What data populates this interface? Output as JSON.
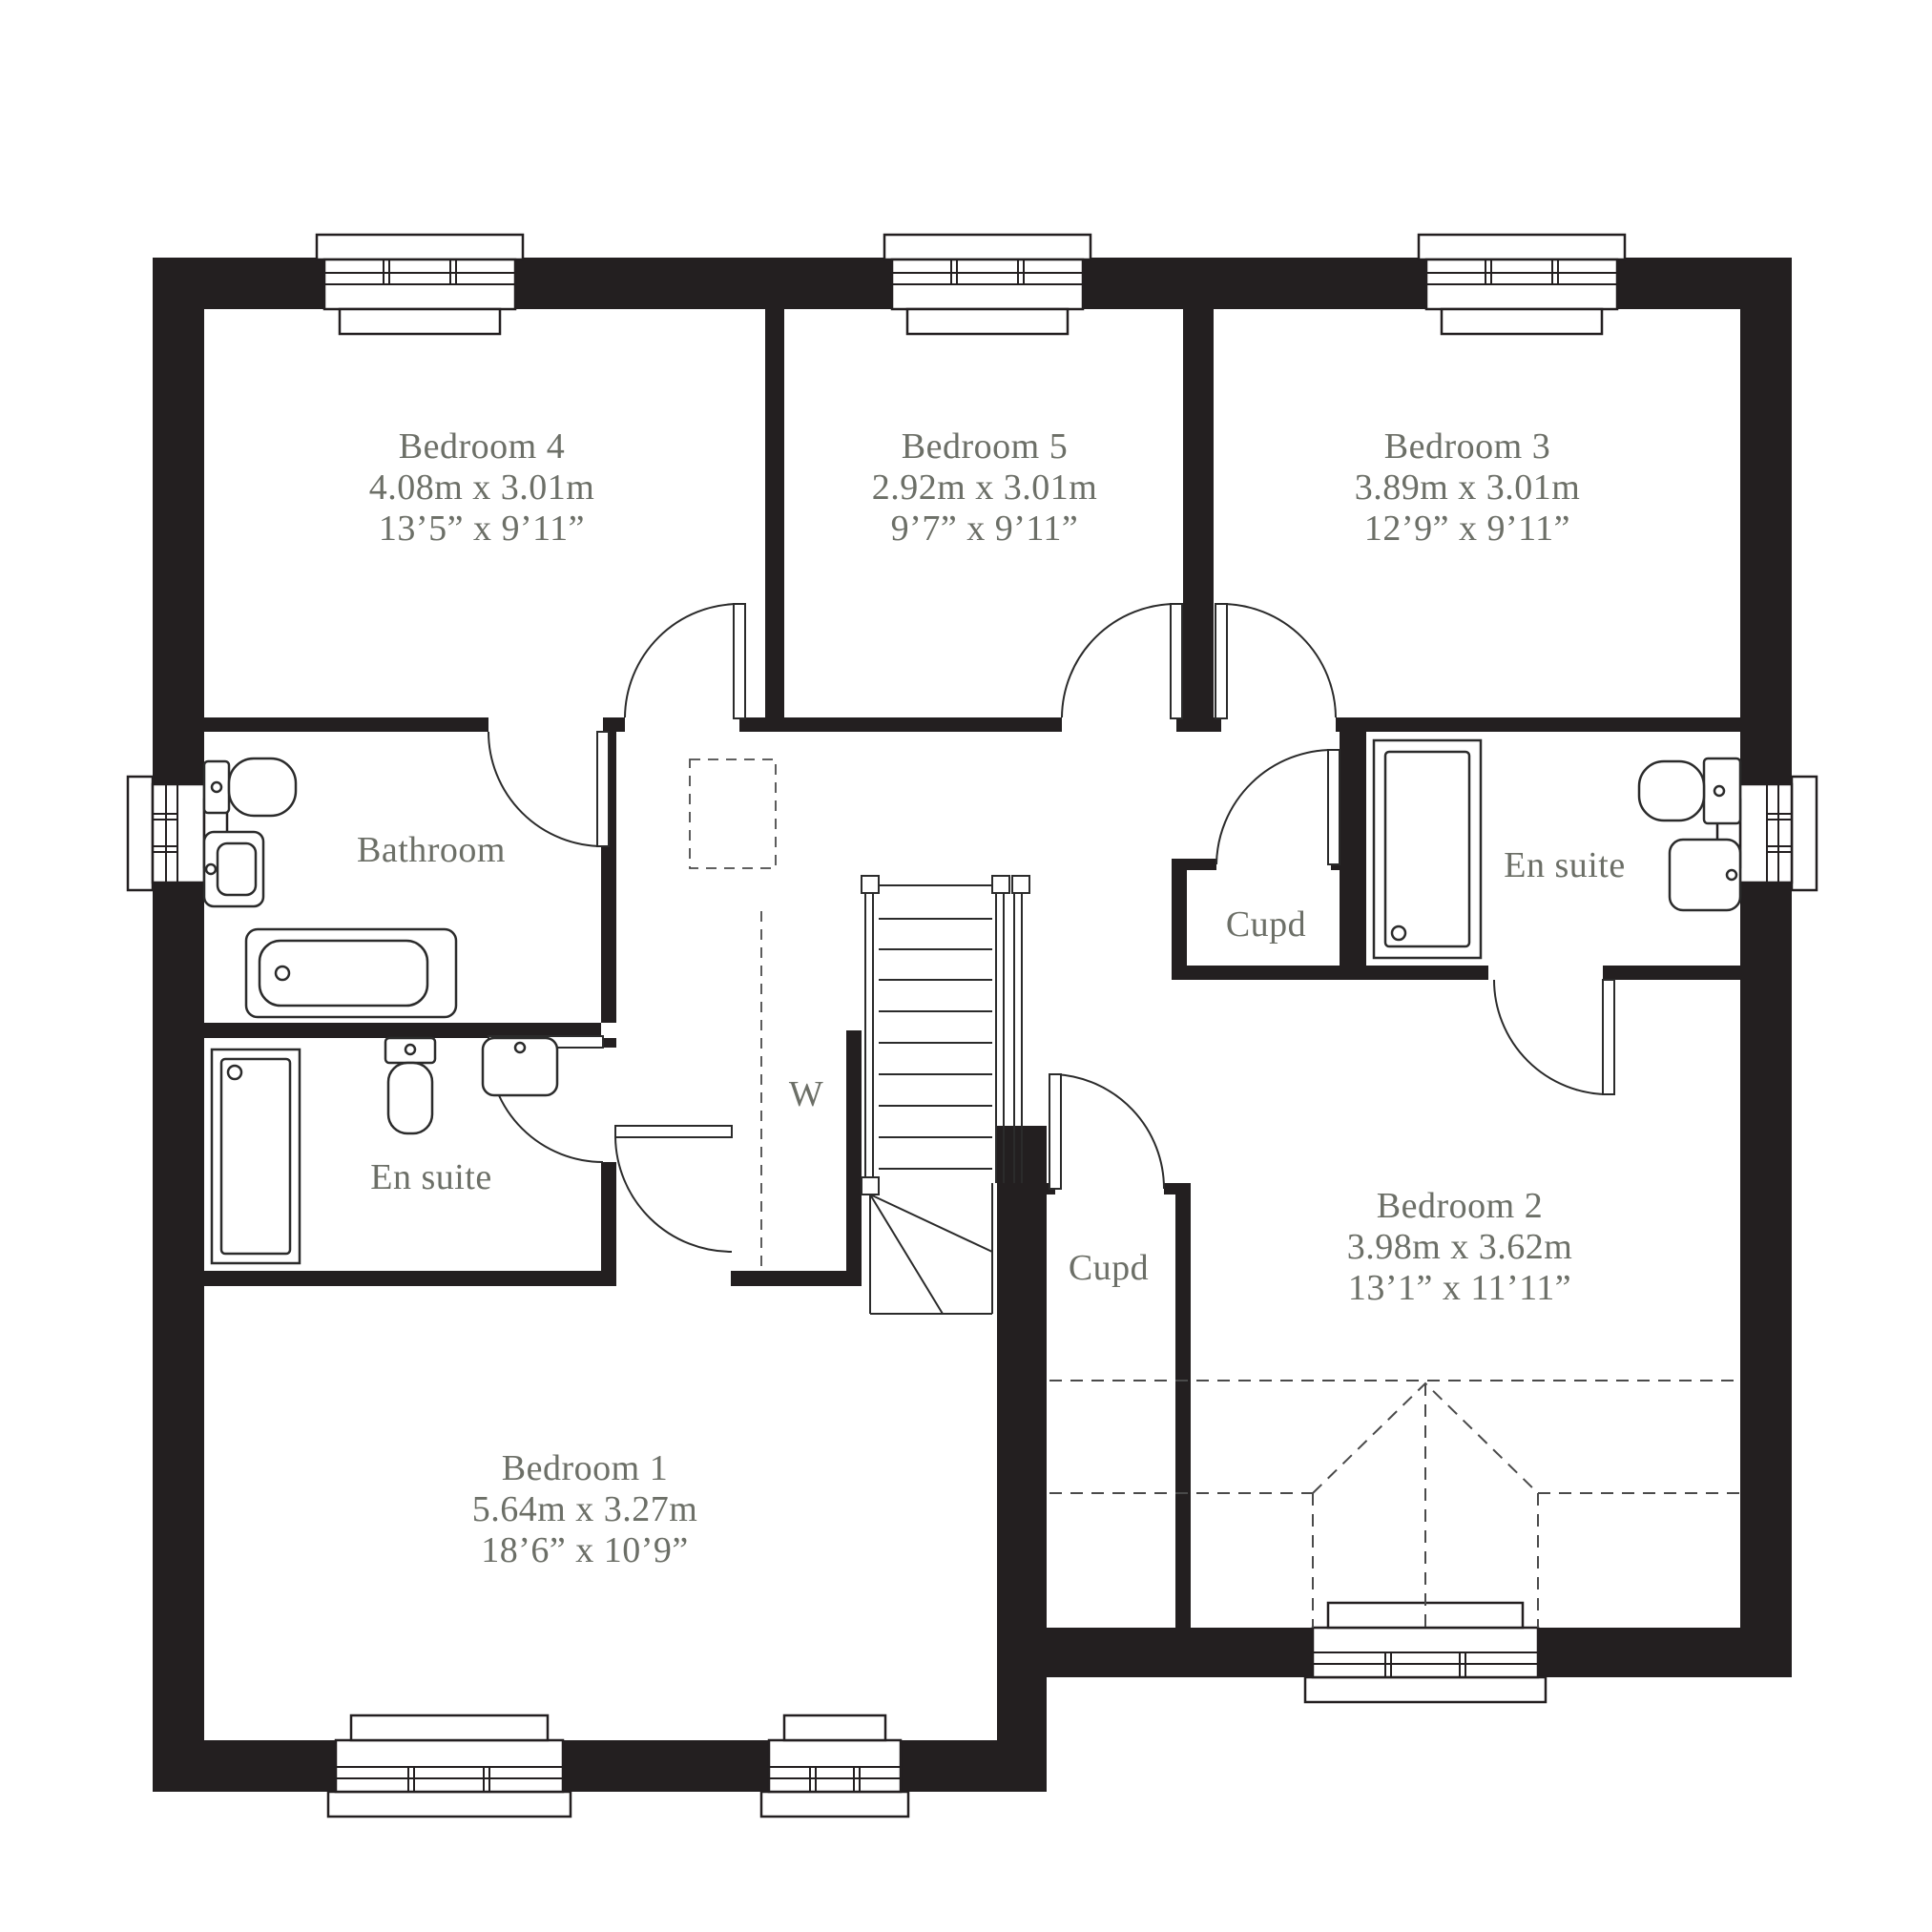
{
  "colors": {
    "wall": "#231f20",
    "label": "#6c6f67"
  },
  "rooms": {
    "bedroom4": {
      "name": "Bedroom 4",
      "metric": "4.08m x 3.01m",
      "imperial": "13’5” x 9’11”"
    },
    "bedroom5": {
      "name": "Bedroom 5",
      "metric": "2.92m x 3.01m",
      "imperial": "9’7” x 9’11”"
    },
    "bedroom3": {
      "name": "Bedroom 3",
      "metric": "3.89m x 3.01m",
      "imperial": "12’9” x 9’11”"
    },
    "bedroom2": {
      "name": "Bedroom 2",
      "metric": "3.98m x 3.62m",
      "imperial": "13’1” x 11’11”"
    },
    "bedroom1": {
      "name": "Bedroom 1",
      "metric": "5.64m x 3.27m",
      "imperial": "18’6” x 10’9”"
    },
    "bathroom": {
      "name": "Bathroom"
    },
    "ensuite_left": {
      "name": "En suite"
    },
    "ensuite_right": {
      "name": "En suite"
    },
    "cupd_upper": {
      "name": "Cupd"
    },
    "cupd_lower": {
      "name": "Cupd"
    },
    "wardrobe": {
      "name": "W"
    }
  }
}
